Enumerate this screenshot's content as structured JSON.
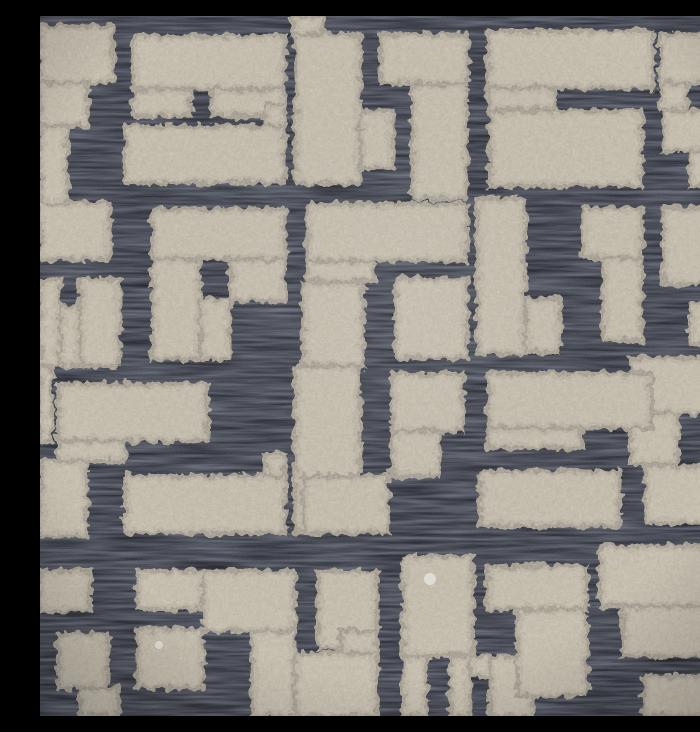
{
  "meta": {
    "description": "Close-up photograph of a cut-velvet upholstery fabric swatch: raised taupe-beige chenille pile blocks forming an interlocking T / L fret-maze pattern over a charcoal blue-black woven satin ground",
    "subject": "geometric cut velvet fabric texture",
    "pattern_style": "interlocking key / fret maze of rectangular bars, feet and square blocks",
    "approx_repeat_px": 350,
    "channel_width_px": 20
  },
  "palette": {
    "ground_dark": "#13151d",
    "ground_sheen": "#4d5466",
    "ground_sheen_soft": "#2c3140",
    "pile_base": "#b4aa97",
    "pile_light": "#cfc5b1",
    "pile_shadow": "#8b8271",
    "lint_white": "#e8e6e0"
  },
  "canvas": {
    "width": 700,
    "height": 700
  },
  "pieces": [
    {
      "id": "sq-notch-tl",
      "rects": [
        [
          0,
          10,
          73,
          57
        ],
        [
          0,
          67,
          48,
          43
        ]
      ]
    },
    {
      "id": "bar-top-1",
      "rects": [
        [
          93,
          20,
          152,
          53
        ],
        [
          93,
          73,
          57,
          27
        ],
        [
          172,
          73,
          73,
          27
        ]
      ]
    },
    {
      "id": "tall-block-top",
      "rects": [
        [
          253,
          0,
          30,
          18
        ],
        [
          255,
          18,
          65,
          150
        ]
      ]
    },
    {
      "id": "bar-stem-top",
      "rects": [
        [
          340,
          18,
          88,
          50
        ],
        [
          372,
          68,
          55,
          115
        ]
      ]
    },
    {
      "id": "bar-top-2",
      "rects": [
        [
          448,
          15,
          165,
          57
        ],
        [
          448,
          72,
          67,
          21
        ]
      ]
    },
    {
      "id": "block-tr",
      "rects": [
        [
          620,
          18,
          80,
          49
        ],
        [
          620,
          67,
          27,
          26
        ],
        [
          670,
          67,
          30,
          26
        ]
      ]
    },
    {
      "id": "strip-left-1",
      "rects": [
        [
          0,
          110,
          27,
          77
        ]
      ]
    },
    {
      "id": "bar-row2-left",
      "rects": [
        [
          85,
          110,
          160,
          57
        ],
        [
          225,
          88,
          20,
          22
        ]
      ]
    },
    {
      "id": "block-row2-mid",
      "rects": [
        [
          320,
          95,
          33,
          57
        ]
      ]
    },
    {
      "id": "block-row2-wide",
      "rects": [
        [
          450,
          95,
          152,
          75
        ]
      ]
    },
    {
      "id": "block-row2-right",
      "rects": [
        [
          623,
          95,
          77,
          40
        ],
        [
          650,
          135,
          50,
          35
        ]
      ]
    },
    {
      "id": "block-left-row3",
      "rects": [
        [
          0,
          187,
          70,
          56
        ]
      ]
    },
    {
      "id": "hook-center-left",
      "rects": [
        [
          112,
          193,
          133,
          50
        ],
        [
          112,
          243,
          48,
          100
        ],
        [
          160,
          283,
          30,
          60
        ],
        [
          190,
          243,
          55,
          42
        ]
      ]
    },
    {
      "id": "block-left-notch",
      "rects": [
        [
          0,
          263,
          20,
          87
        ],
        [
          40,
          263,
          40,
          87
        ],
        [
          20,
          290,
          20,
          60
        ]
      ]
    },
    {
      "id": "bar-row3",
      "rects": [
        [
          267,
          188,
          160,
          57
        ],
        [
          267,
          245,
          67,
          20
        ]
      ]
    },
    {
      "id": "block-under-bar3",
      "rects": [
        [
          263,
          267,
          60,
          83
        ]
      ]
    },
    {
      "id": "block-mid-1",
      "rects": [
        [
          355,
          262,
          72,
          80
        ]
      ]
    },
    {
      "id": "col-step-mid",
      "rects": [
        [
          437,
          183,
          48,
          155
        ],
        [
          485,
          283,
          35,
          53
        ]
      ]
    },
    {
      "id": "step-right-mid",
      "rects": [
        [
          543,
          192,
          59,
          50
        ],
        [
          563,
          242,
          39,
          83
        ]
      ]
    },
    {
      "id": "block-right-row3",
      "rects": [
        [
          623,
          192,
          77,
          76
        ]
      ]
    },
    {
      "id": "block-right-small",
      "rects": [
        [
          650,
          288,
          50,
          40
        ]
      ]
    },
    {
      "id": "bar-right-mid",
      "rects": [
        [
          590,
          342,
          110,
          55
        ],
        [
          590,
          397,
          48,
          50
        ]
      ]
    },
    {
      "id": "sq-notch-center",
      "rects": [
        [
          352,
          358,
          71,
          57
        ],
        [
          352,
          415,
          48,
          45
        ]
      ]
    },
    {
      "id": "bar-center-1",
      "rects": [
        [
          448,
          357,
          164,
          55
        ],
        [
          448,
          412,
          94,
          20
        ]
      ]
    },
    {
      "id": "bar-center-2",
      "rects": [
        [
          440,
          455,
          140,
          55
        ]
      ]
    },
    {
      "id": "bar-right-low",
      "rects": [
        [
          605,
          450,
          95,
          57
        ]
      ]
    },
    {
      "id": "bar-left-mid",
      "rects": [
        [
          18,
          368,
          149,
          57
        ],
        [
          18,
          425,
          67,
          20
        ],
        [
          0,
          350,
          12,
          75
        ]
      ]
    },
    {
      "id": "tall-block-left",
      "rects": [
        [
          255,
          350,
          65,
          167
        ]
      ]
    },
    {
      "id": "block-left-low",
      "rects": [
        [
          0,
          445,
          47,
          75
        ]
      ]
    },
    {
      "id": "bar-row4-left",
      "rects": [
        [
          85,
          460,
          160,
          57
        ],
        [
          225,
          438,
          20,
          22
        ]
      ]
    },
    {
      "id": "block-row4-mid",
      "rects": [
        [
          263,
          460,
          85,
          57
        ]
      ]
    },
    {
      "id": "step-bl-corner",
      "rects": [
        [
          0,
          555,
          50,
          40
        ],
        [
          18,
          618,
          50,
          54
        ],
        [
          40,
          672,
          38,
          28
        ]
      ]
    },
    {
      "id": "block-bl-upper",
      "rects": [
        [
          97,
          555,
          66,
          38
        ]
      ]
    },
    {
      "id": "block-bl-lower",
      "rects": [
        [
          97,
          613,
          66,
          59
        ]
      ]
    },
    {
      "id": "step-bottom-1",
      "rects": [
        [
          163,
          555,
          92,
          60
        ],
        [
          212,
          615,
          43,
          85
        ]
      ]
    },
    {
      "id": "zig-bottom",
      "rects": [
        [
          278,
          555,
          59,
          77
        ],
        [
          255,
          637,
          82,
          63
        ],
        [
          300,
          615,
          37,
          22
        ]
      ]
    },
    {
      "id": "block-bottom-c1",
      "rects": [
        [
          363,
          540,
          70,
          100
        ],
        [
          363,
          640,
          24,
          60
        ]
      ]
    },
    {
      "id": "block-bottom-notch",
      "rects": [
        [
          410,
          640,
          20,
          60
        ],
        [
          450,
          640,
          43,
          60
        ],
        [
          430,
          640,
          20,
          20
        ]
      ]
    },
    {
      "id": "tee-bottom",
      "rects": [
        [
          447,
          550,
          100,
          43
        ],
        [
          477,
          593,
          70,
          87
        ]
      ]
    },
    {
      "id": "hook-br",
      "rects": [
        [
          560,
          530,
          140,
          60
        ],
        [
          583,
          590,
          117,
          50
        ]
      ]
    },
    {
      "id": "block-br-low",
      "rects": [
        [
          603,
          660,
          97,
          40
        ]
      ]
    }
  ],
  "specks": [
    {
      "id": "lint-1",
      "x": 390,
      "y": 563,
      "r": 6
    },
    {
      "id": "lint-2",
      "x": 119,
      "y": 629,
      "r": 4
    }
  ]
}
